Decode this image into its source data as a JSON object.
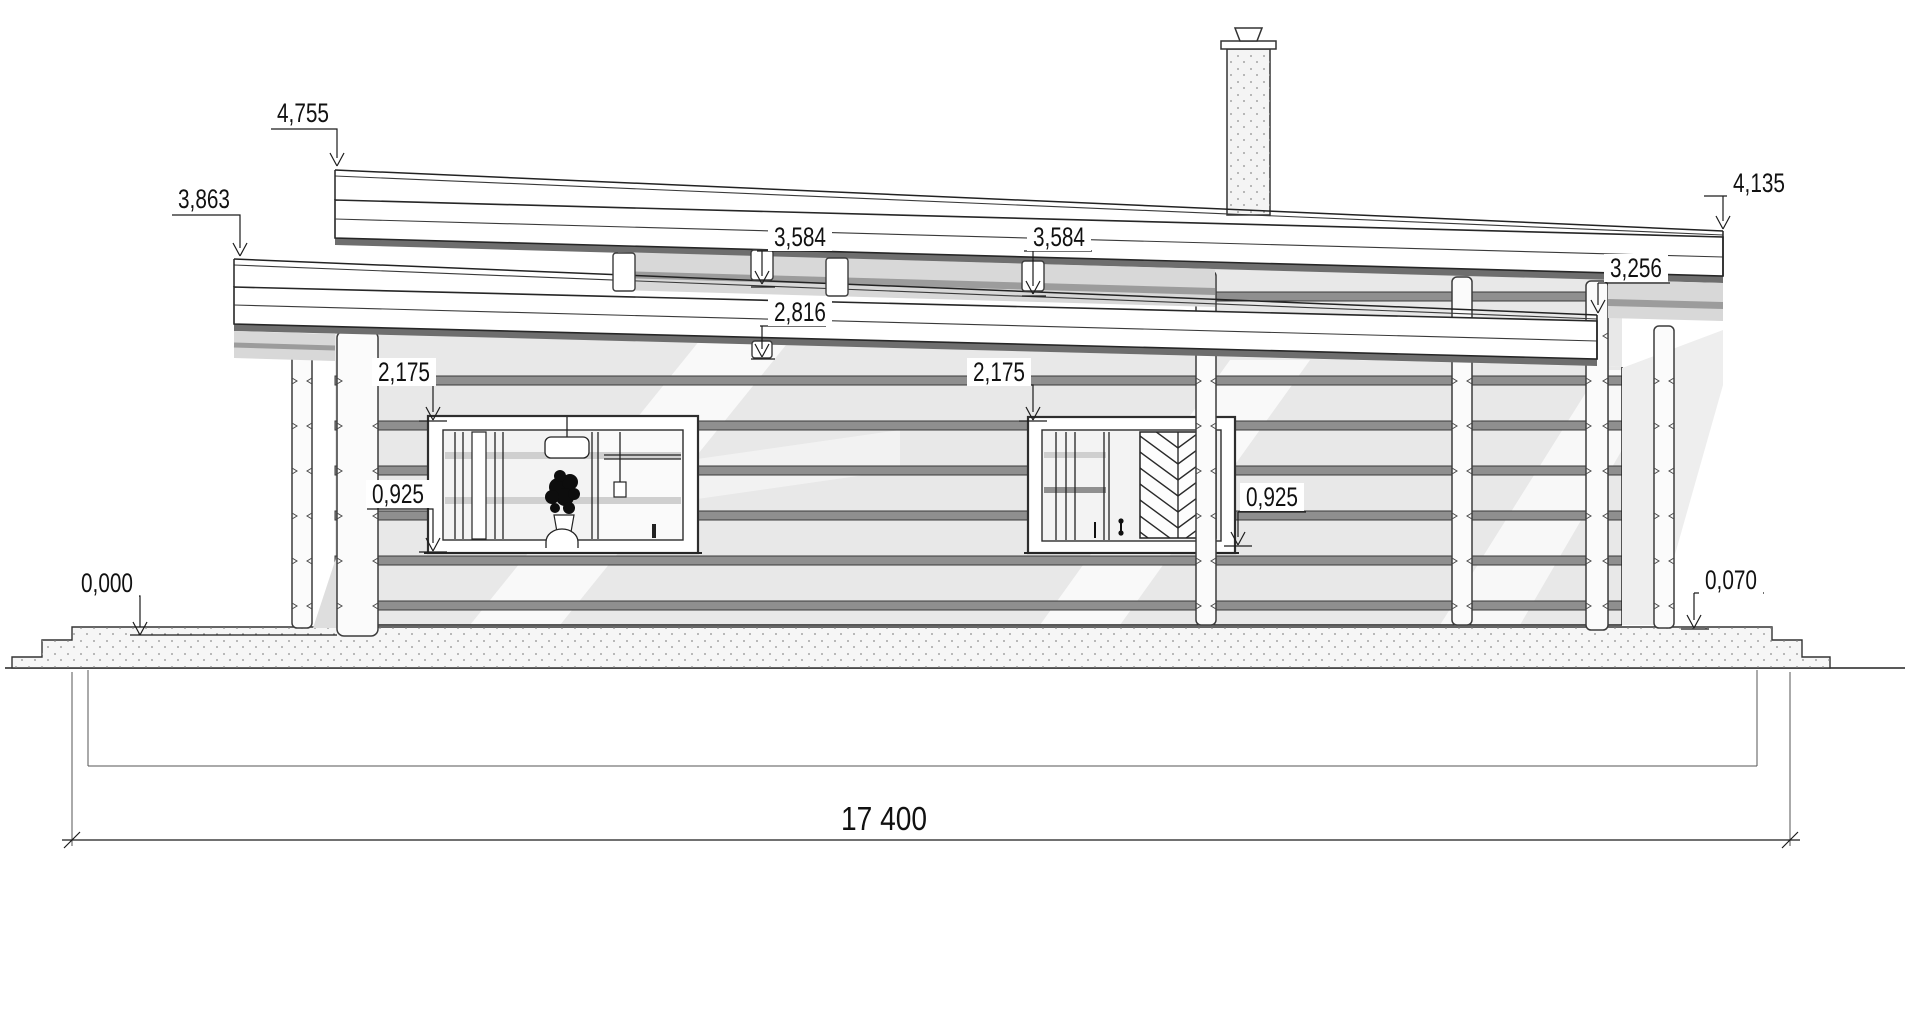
{
  "drawing": {
    "type": "architectural-elevation",
    "overall_width": "17 400",
    "labels": {
      "roof_high_left": "4,755",
      "roof_low_left": "3,863",
      "beam_mid_1": "3,584",
      "beam_mid_2": "3,584",
      "porch_ceiling": "2,816",
      "roof_high_right": "4,135",
      "roof_low_right": "3,256",
      "window_head_left": "2,175",
      "window_head_right": "2,175",
      "window_sill_left": "0,925",
      "window_sill_right": "0,925",
      "level_zero": "0,000",
      "terrace_right": "0,070"
    }
  },
  "colors": {
    "ink": "#222222",
    "wall": "#e8e8e8",
    "stripe": "#8f8f8f",
    "soffit": "#d8d8d8",
    "underband": "#6e6e6e",
    "concrete": "#f6f6f6",
    "paper": "#ffffff"
  }
}
